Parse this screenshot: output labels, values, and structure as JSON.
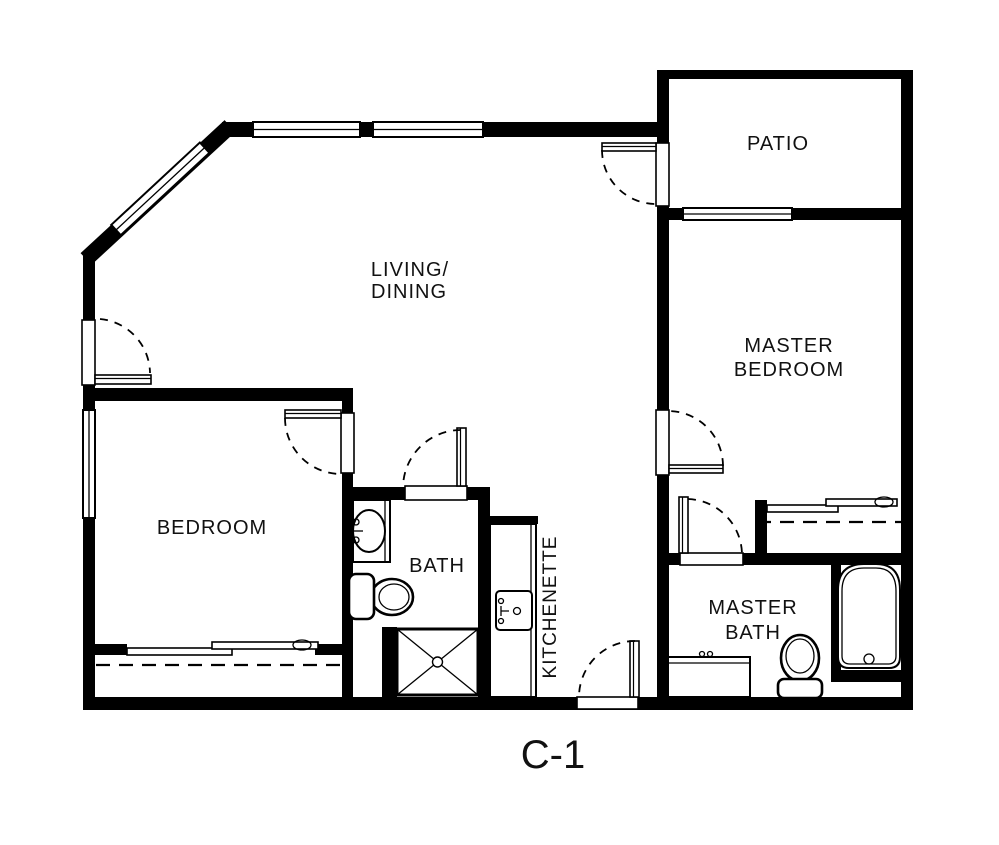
{
  "plan": {
    "code": "C-1"
  },
  "rooms": {
    "living_dining": {
      "line1": "LIVING/",
      "line2": "DINING"
    },
    "patio": {
      "label": "PATIO"
    },
    "master_bedroom": {
      "line1": "MASTER",
      "line2": "BEDROOM"
    },
    "bedroom": {
      "label": "BEDROOM"
    },
    "bath": {
      "label": "BATH"
    },
    "kitchenette": {
      "label": "KITCHENETTE"
    },
    "master_bath": {
      "line1": "MASTER",
      "line2": "BATH"
    }
  },
  "colors": {
    "wall": "#000000",
    "background": "#ffffff",
    "text": "#111111"
  }
}
